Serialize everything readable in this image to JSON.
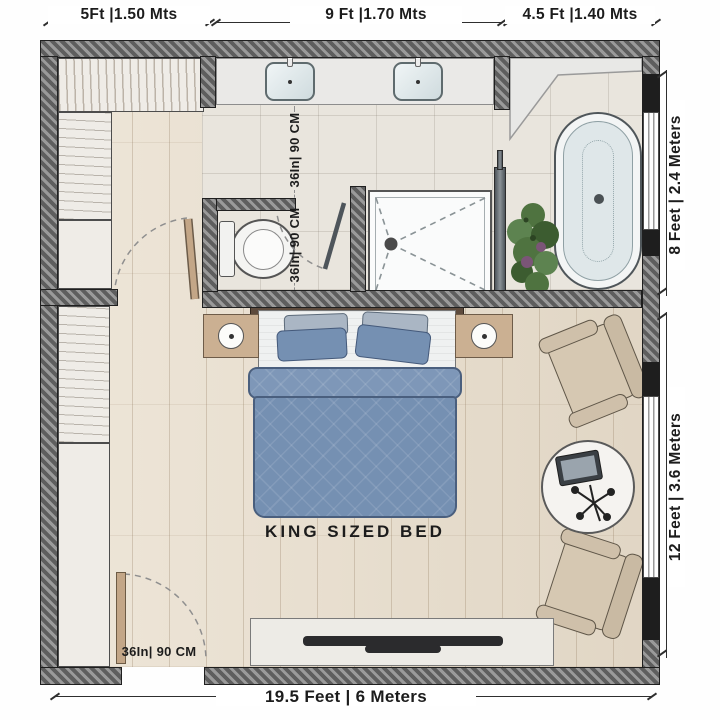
{
  "plan": {
    "type": "floor-plan",
    "room": "master bedroom with ensuite bathroom and walk-in closet",
    "bed_area_label": "KING SIZED BED",
    "dimensions": {
      "top_left": "5Ft |1.50 Mts",
      "top_middle": "9 Ft |1.70 Mts",
      "top_right": "4.5 Ft |1.40 Mts",
      "right_upper": "8 Feet | 2.4 Meters",
      "right_lower": "12 Feet | 3.6 Meters",
      "bottom": "19.5 Feet | 6 Meters",
      "passage_width": "36In| 90 CM",
      "wc_width": "36In| 90 CM",
      "entry_door_width": "36In| 90 CM"
    },
    "fixtures": [
      "walk-in-closet",
      "wardrobe",
      "double-sink-vanity",
      "toilet",
      "walk-in-shower",
      "shower-glass-panel",
      "freestanding-bathtub",
      "potted-plant",
      "king-bed",
      "nightstand-with-lamp",
      "armchair",
      "round-side-table",
      "tablet",
      "decor-sprig",
      "tv-console",
      "tv",
      "entry-door",
      "closet-door",
      "wc-door",
      "window"
    ],
    "colors": {
      "wall": "#808080",
      "wood_floor": "#e8ddcb",
      "tile_floor": "#e9e5dd",
      "duvet_blue": "#7590b2",
      "chair_beige": "#d6c8b2",
      "nightstand_tan": "#cbb092",
      "plant_green": "#4f7340",
      "tub_inner": "#dfe7e9",
      "dimension_text": "#1c1c1c"
    }
  }
}
